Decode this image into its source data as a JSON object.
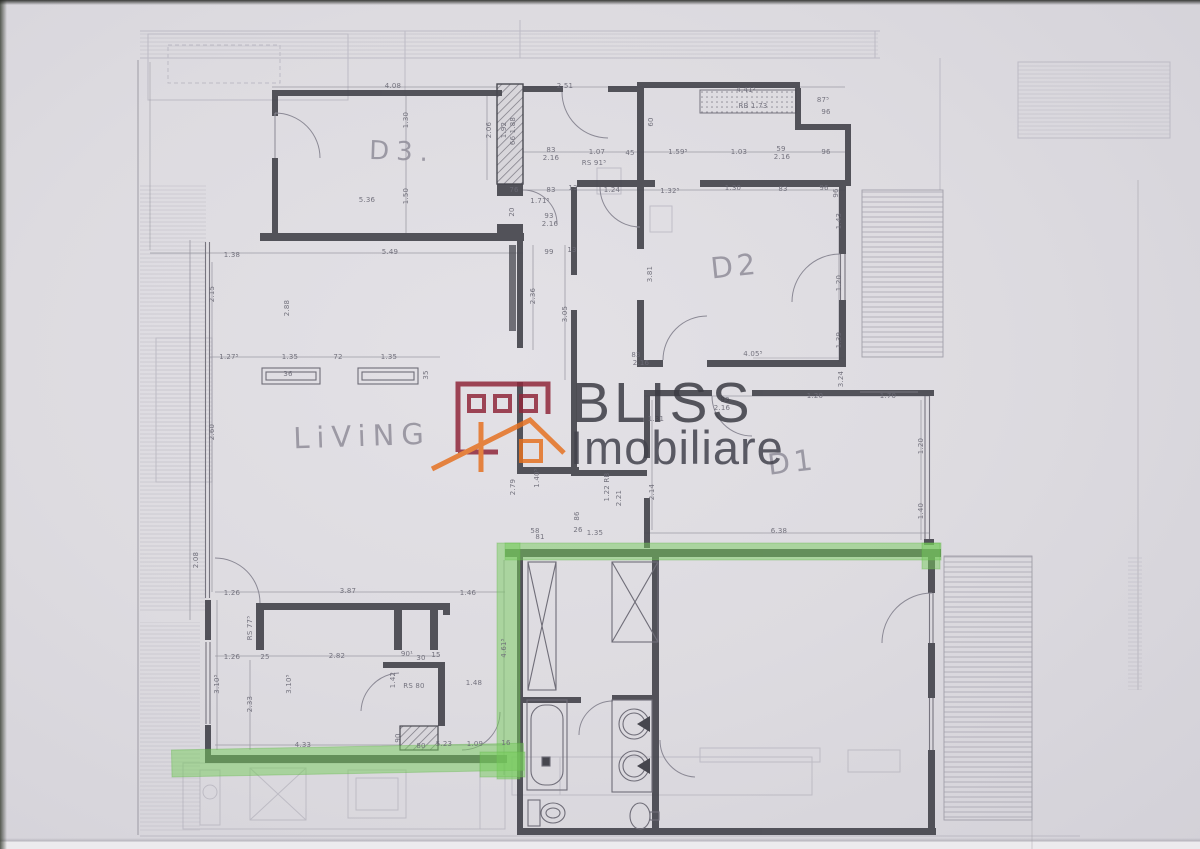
{
  "watermark": {
    "brand": "BLISS",
    "subtitle": "Imobiliare",
    "maroon": "#8e2639",
    "orange": "#e5701f",
    "text_color": "#3a3a42"
  },
  "plan": {
    "highlight_color": "rgba(118,204,92,0.5)",
    "rooms": [
      {
        "label": "D3.",
        "x": 402,
        "y": 152,
        "size": 26,
        "ls": 7,
        "rot": 2
      },
      {
        "label": "D2",
        "x": 735,
        "y": 266,
        "size": 29,
        "ls": 4,
        "rot": -6
      },
      {
        "label": "D1",
        "x": 792,
        "y": 462,
        "size": 29,
        "ls": 4,
        "rot": -7
      },
      {
        "label": "LiViNG",
        "x": 362,
        "y": 436,
        "size": 29,
        "ls": 7,
        "rot": -2
      }
    ],
    "dimensions": [
      {
        "t": "4.08",
        "x": 393,
        "y": 86
      },
      {
        "t": "2.51",
        "x": 565,
        "y": 86
      },
      {
        "t": "4.41⁵",
        "x": 746,
        "y": 90
      },
      {
        "t": "RB 1.73",
        "x": 753,
        "y": 106
      },
      {
        "t": "96",
        "x": 826,
        "y": 112
      },
      {
        "t": "87⁵",
        "x": 823,
        "y": 100
      },
      {
        "t": "1.30",
        "x": 406,
        "y": 120,
        "v": 1
      },
      {
        "t": "1.50",
        "x": 406,
        "y": 196,
        "v": 1
      },
      {
        "t": "2.06",
        "x": 489,
        "y": 130,
        "v": 1
      },
      {
        "t": "1.92",
        "x": 504,
        "y": 130,
        "v": 1
      },
      {
        "t": "66 1.88",
        "x": 513,
        "y": 131,
        "v": 1
      },
      {
        "t": "83",
        "x": 551,
        "y": 150
      },
      {
        "t": "2.16",
        "x": 551,
        "y": 158
      },
      {
        "t": "1.07",
        "x": 597,
        "y": 152
      },
      {
        "t": "RS  91⁵",
        "x": 594,
        "y": 163
      },
      {
        "t": "45",
        "x": 630,
        "y": 153
      },
      {
        "t": "1.59⁵",
        "x": 678,
        "y": 152
      },
      {
        "t": "1.03",
        "x": 739,
        "y": 152
      },
      {
        "t": "59",
        "x": 781,
        "y": 149
      },
      {
        "t": "2.16",
        "x": 782,
        "y": 157
      },
      {
        "t": "96",
        "x": 826,
        "y": 152
      },
      {
        "t": "60",
        "x": 651,
        "y": 122,
        "v": 1
      },
      {
        "t": "76",
        "x": 514,
        "y": 190
      },
      {
        "t": "83",
        "x": 551,
        "y": 190
      },
      {
        "t": "13",
        "x": 573,
        "y": 188
      },
      {
        "t": "1.71⁵",
        "x": 540,
        "y": 201
      },
      {
        "t": "1.24",
        "x": 612,
        "y": 190
      },
      {
        "t": "1.32⁵",
        "x": 670,
        "y": 191
      },
      {
        "t": "1.30",
        "x": 733,
        "y": 188
      },
      {
        "t": "83",
        "x": 783,
        "y": 189
      },
      {
        "t": "96",
        "x": 824,
        "y": 188
      },
      {
        "t": "20",
        "x": 512,
        "y": 212,
        "v": 1
      },
      {
        "t": "93",
        "x": 549,
        "y": 216
      },
      {
        "t": "2.16",
        "x": 550,
        "y": 224
      },
      {
        "t": "5.36",
        "x": 367,
        "y": 200
      },
      {
        "t": "5.49",
        "x": 390,
        "y": 252
      },
      {
        "t": "1.38",
        "x": 232,
        "y": 255
      },
      {
        "t": "99",
        "x": 549,
        "y": 252
      },
      {
        "t": "13",
        "x": 572,
        "y": 250
      },
      {
        "t": "2.15",
        "x": 212,
        "y": 294,
        "v": 1
      },
      {
        "t": "2.88",
        "x": 287,
        "y": 308,
        "v": 1
      },
      {
        "t": "2.36",
        "x": 533,
        "y": 296,
        "v": 1
      },
      {
        "t": "3.05",
        "x": 565,
        "y": 314,
        "v": 1
      },
      {
        "t": "3.81",
        "x": 650,
        "y": 274,
        "v": 1
      },
      {
        "t": "1.43",
        "x": 839,
        "y": 221,
        "v": 1
      },
      {
        "t": "1.20",
        "x": 839,
        "y": 283,
        "v": 1
      },
      {
        "t": "1.39",
        "x": 839,
        "y": 340,
        "v": 1
      },
      {
        "t": "4.05⁵",
        "x": 753,
        "y": 354
      },
      {
        "t": "83",
        "x": 636,
        "y": 355
      },
      {
        "t": "2.16",
        "x": 641,
        "y": 363
      },
      {
        "t": "1.27⁵",
        "x": 229,
        "y": 357
      },
      {
        "t": "1.35",
        "x": 290,
        "y": 357
      },
      {
        "t": "72",
        "x": 338,
        "y": 357
      },
      {
        "t": "1.35",
        "x": 389,
        "y": 357
      },
      {
        "t": "36",
        "x": 288,
        "y": 374
      },
      {
        "t": "35",
        "x": 426,
        "y": 375,
        "v": 1
      },
      {
        "t": "2.60",
        "x": 212,
        "y": 432,
        "v": 1
      },
      {
        "t": "1.20",
        "x": 815,
        "y": 396
      },
      {
        "t": "1.70",
        "x": 888,
        "y": 396
      },
      {
        "t": "93",
        "x": 725,
        "y": 400
      },
      {
        "t": "2.16",
        "x": 722,
        "y": 408
      },
      {
        "t": "1.31",
        "x": 656,
        "y": 419
      },
      {
        "t": "3.24",
        "x": 841,
        "y": 379,
        "v": 1
      },
      {
        "t": "1.20",
        "x": 921,
        "y": 446,
        "v": 1
      },
      {
        "t": "1.40",
        "x": 921,
        "y": 511,
        "v": 1
      },
      {
        "t": "2.14",
        "x": 652,
        "y": 492,
        "v": 1
      },
      {
        "t": "6.38",
        "x": 779,
        "y": 531
      },
      {
        "t": "2.79",
        "x": 513,
        "y": 487,
        "v": 1
      },
      {
        "t": "1.40⁵",
        "x": 537,
        "y": 478,
        "v": 1
      },
      {
        "t": "1.22 RB",
        "x": 607,
        "y": 487,
        "v": 1
      },
      {
        "t": "2.21",
        "x": 619,
        "y": 498,
        "v": 1
      },
      {
        "t": "86",
        "x": 577,
        "y": 516,
        "v": 1
      },
      {
        "t": "58",
        "x": 535,
        "y": 531
      },
      {
        "t": "26",
        "x": 578,
        "y": 530
      },
      {
        "t": "1.35",
        "x": 595,
        "y": 533
      },
      {
        "t": "81",
        "x": 540,
        "y": 537
      },
      {
        "t": "2.08",
        "x": 196,
        "y": 560,
        "v": 1
      },
      {
        "t": "1.26",
        "x": 232,
        "y": 593
      },
      {
        "t": "3.87",
        "x": 348,
        "y": 591
      },
      {
        "t": "1.46",
        "x": 468,
        "y": 593
      },
      {
        "t": "RS 77⁵",
        "x": 250,
        "y": 628,
        "v": 1
      },
      {
        "t": "1.26",
        "x": 232,
        "y": 657
      },
      {
        "t": "25",
        "x": 265,
        "y": 657
      },
      {
        "t": "2.82",
        "x": 337,
        "y": 656
      },
      {
        "t": "90¹",
        "x": 407,
        "y": 654
      },
      {
        "t": "30",
        "x": 421,
        "y": 658
      },
      {
        "t": "15",
        "x": 436,
        "y": 655
      },
      {
        "t": "3.10⁵",
        "x": 217,
        "y": 684,
        "v": 1
      },
      {
        "t": "2.33",
        "x": 250,
        "y": 704,
        "v": 1
      },
      {
        "t": "3.10⁵",
        "x": 289,
        "y": 684,
        "v": 1
      },
      {
        "t": "RS 80",
        "x": 414,
        "y": 686
      },
      {
        "t": "1.48",
        "x": 474,
        "y": 683
      },
      {
        "t": "1.42",
        "x": 393,
        "y": 680,
        "v": 1
      },
      {
        "t": "4.33",
        "x": 303,
        "y": 745
      },
      {
        "t": "90",
        "x": 398,
        "y": 738,
        "v": 1
      },
      {
        "t": "80",
        "x": 421,
        "y": 746
      },
      {
        "t": "5.23",
        "x": 444,
        "y": 744
      },
      {
        "t": "1.09",
        "x": 475,
        "y": 744
      },
      {
        "t": "16",
        "x": 506,
        "y": 743
      },
      {
        "t": "4.61⁵",
        "x": 504,
        "y": 648,
        "v": 1
      },
      {
        "t": "96",
        "x": 836,
        "y": 193,
        "v": 1
      }
    ]
  }
}
